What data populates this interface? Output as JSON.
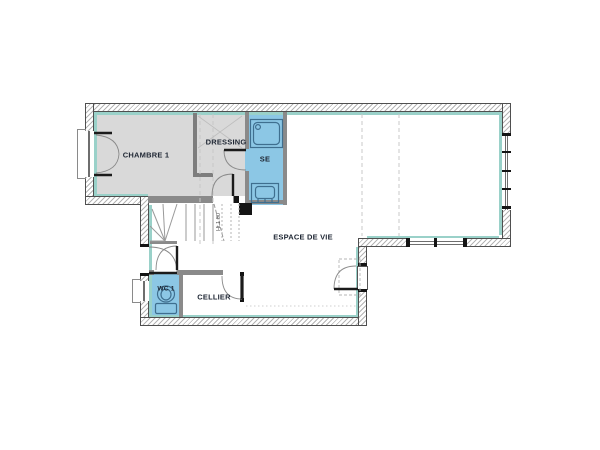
{
  "plan": {
    "type": "architectural-floor-plan",
    "rooms": [
      {
        "id": "chambre-1",
        "label": "CHAMBRE 1"
      },
      {
        "id": "dressing",
        "label": "DRESSING"
      },
      {
        "id": "salle-eau",
        "label": "SE"
      },
      {
        "id": "espace-de-vie",
        "label": "ESPACE DE VIE"
      },
      {
        "id": "wc-1",
        "label": "WC 1"
      },
      {
        "id": "cellier",
        "label": "CELLIER"
      }
    ],
    "annotations": {
      "stair_height": "Ht 1.80"
    },
    "colors": {
      "wet_room_fill": "#8cc7e5",
      "room_grey": "#d9d9d9",
      "insulation": "#9ad1c9",
      "partition": "#8a8a8a",
      "wall_hatch": "#b4b4b4",
      "wall_line": "#4f4f4f",
      "fixture": "#3f6f8f",
      "label": "#1e2633"
    }
  }
}
